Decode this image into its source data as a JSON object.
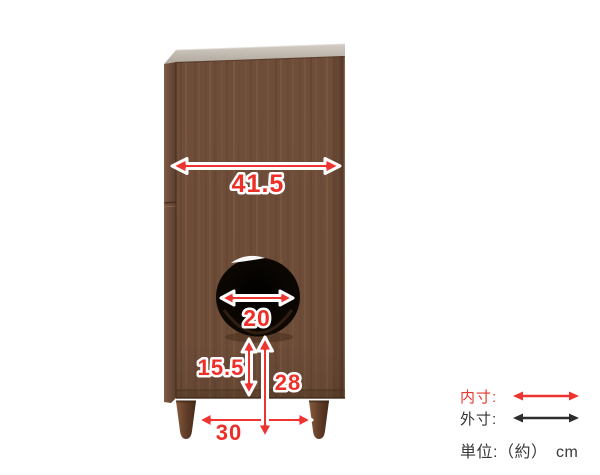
{
  "diagram": {
    "dimensions": {
      "top_inner_width": "41.5",
      "hole_diameter": "20",
      "hole_to_base": "15.5",
      "hole_to_floor": "28",
      "bottom_leg_span": "30"
    }
  },
  "legend": {
    "inner_label": "内寸:",
    "outer_label": "外寸:",
    "unit_label": "単位:（約）　cm"
  },
  "colors": {
    "dimension_red": "#ee3430",
    "outer_arrow_black": "#2d2d2d",
    "wood_panel": "#6f4e39",
    "wood_top": "#c6c0b6",
    "hole_black": "#130c07"
  }
}
